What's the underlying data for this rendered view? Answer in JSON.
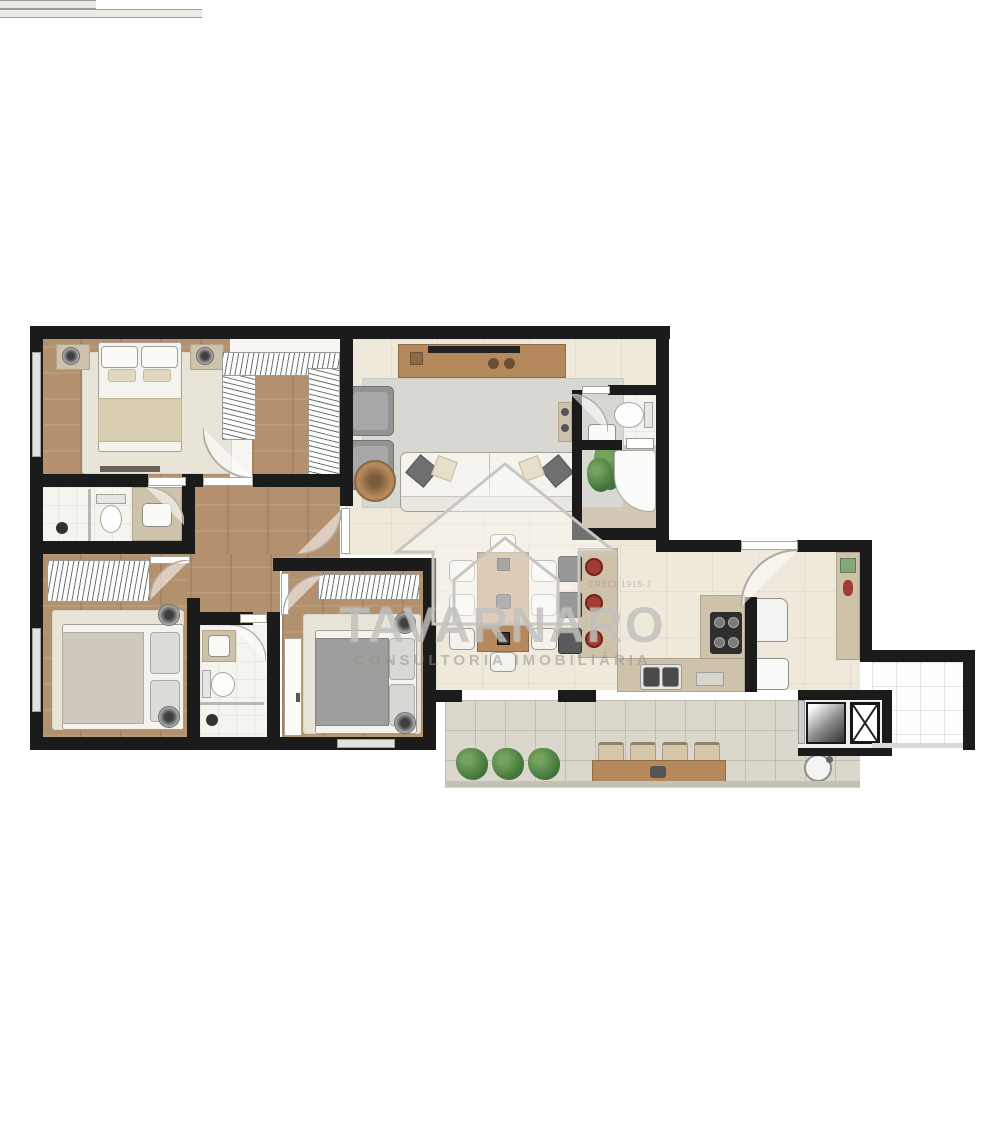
{
  "watermark": {
    "brand": "TAVARNARO",
    "tagline": "CONSULTORIA IMOBILIÁRIA",
    "registration": "CRECI 1915-J"
  },
  "palette": {
    "wall": "#1b1b1b",
    "wood": "#b3916f",
    "tile": "#efe9dc",
    "balcony_tile": "#dbd7cc",
    "counter": "#cfc2ab",
    "wood_furniture": "#b5895c",
    "sofa_white": "#f4f3ee",
    "rug_beige": "#e9e4d8",
    "rug_gray": "#d8d7d2",
    "plant_green": "#41743a",
    "accent_red": "#a03c32",
    "watermark_gray": "#a3a09b"
  },
  "plan": {
    "rooms": [
      {
        "id": "master-bedroom",
        "floor": "wood"
      },
      {
        "id": "walk-in-closet",
        "floor": "white"
      },
      {
        "id": "master-bathroom",
        "floor": "tile"
      },
      {
        "id": "hallway",
        "floor": "wood"
      },
      {
        "id": "bedroom-2",
        "floor": "wood"
      },
      {
        "id": "bathroom-2",
        "floor": "tile"
      },
      {
        "id": "bedroom-3",
        "floor": "wood"
      },
      {
        "id": "living-room",
        "floor": "tile"
      },
      {
        "id": "social-bathroom",
        "floor": "tile"
      },
      {
        "id": "dining-area",
        "floor": "tile"
      },
      {
        "id": "kitchen",
        "floor": "tile"
      },
      {
        "id": "service-area",
        "floor": "tile"
      },
      {
        "id": "gourmet-balcony",
        "floor": "tile"
      },
      {
        "id": "side-terrace",
        "floor": "tile"
      }
    ]
  }
}
